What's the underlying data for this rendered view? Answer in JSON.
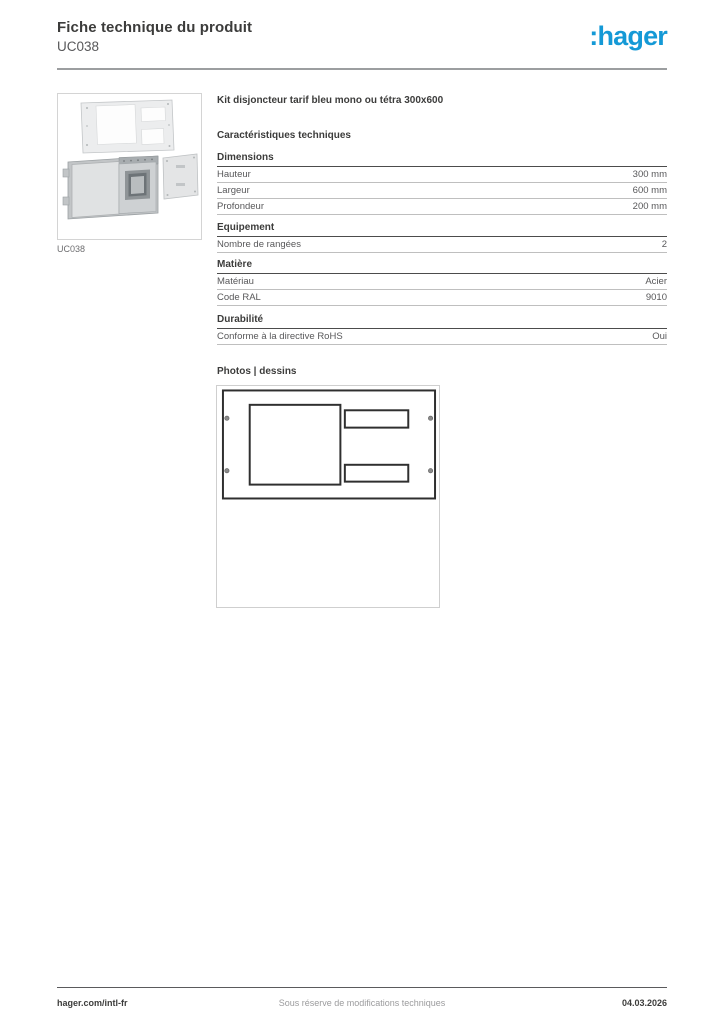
{
  "header": {
    "title": "Fiche technique du produit",
    "subtitle": "UC038",
    "brand": ":hager",
    "brand_color": "#1499d6"
  },
  "product_image": {
    "caption": "UC038",
    "description_icon": "exploded-view-metal-kit"
  },
  "content": {
    "product_name": "Kit disjoncteur tarif bleu mono ou tétra 300x600",
    "characteristics_title": "Caractéristiques techniques",
    "sections": [
      {
        "title": "Dimensions",
        "rows": [
          {
            "label": "Hauteur",
            "value": "300 mm"
          },
          {
            "label": "Largeur",
            "value": "600 mm"
          },
          {
            "label": "Profondeur",
            "value": "200 mm"
          }
        ]
      },
      {
        "title": "Equipement",
        "rows": [
          {
            "label": "Nombre de rangées",
            "value": "2"
          }
        ]
      },
      {
        "title": "Matière",
        "rows": [
          {
            "label": "Matériau",
            "value": "Acier"
          },
          {
            "label": "Code RAL",
            "value": "9010"
          }
        ]
      },
      {
        "title": "Durabilité",
        "rows": [
          {
            "label": "Conforme à la directive RoHS",
            "value": "Oui"
          }
        ]
      }
    ],
    "photos_title": "Photos | dessins"
  },
  "footer": {
    "left": "hager.com/intl-fr",
    "center": "Sous réserve de modifications techniques",
    "right": "04.03.2026"
  }
}
